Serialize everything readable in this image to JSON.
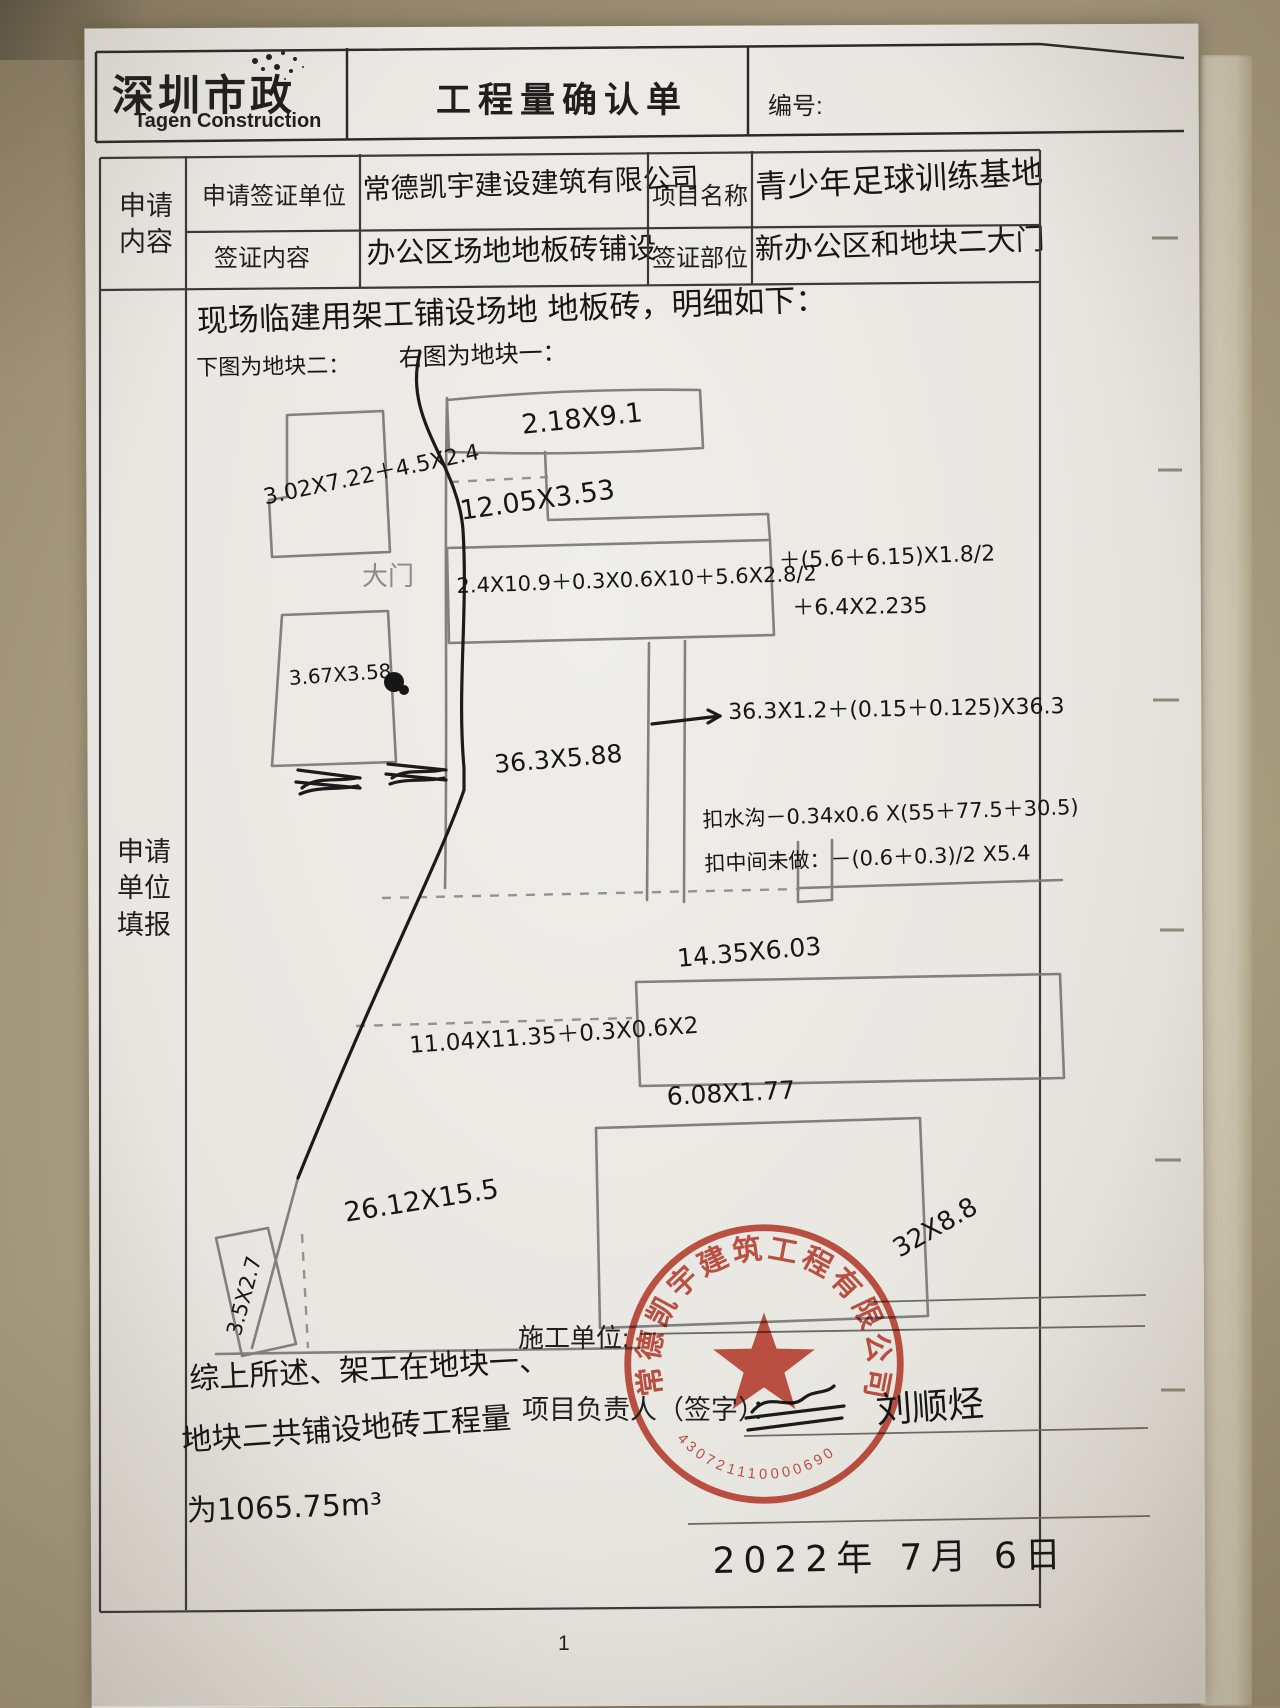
{
  "header": {
    "logo_cn": "深圳市政",
    "logo_en": "Tagen Construction",
    "title": "工程量确认单",
    "no_label": "编号:",
    "no_value": ""
  },
  "form": {
    "row_label_1": "申请",
    "row_label_2": "内容",
    "section_label_1": "申请",
    "section_label_2": "单位",
    "section_label_3": "填报",
    "fields": [
      {
        "label": "申请签证单位",
        "value": "常德凯宇建设建筑有限公司"
      },
      {
        "label": "项目名称",
        "value": "青少年足球训练基地"
      },
      {
        "label": "签证内容",
        "value": "办公区场地地板砖铺设"
      },
      {
        "label": "签证部位",
        "value": "新办公区和地块二大门"
      }
    ]
  },
  "sketch": {
    "labels": [
      {
        "n": "intro-line-1",
        "t": "现场临建用架工铺设场地 地板砖，明细如下：",
        "x": 196,
        "y": 296,
        "s": 31,
        "r": -2
      },
      {
        "n": "intro-line-2-left",
        "t": "下图为地块二：",
        "x": 196,
        "y": 350,
        "s": 22,
        "r": -1
      },
      {
        "n": "intro-line-2-right",
        "t": "右图为地块一：",
        "x": 398,
        "y": 338,
        "s": 24,
        "r": -2
      },
      {
        "n": "dim-plot1-top",
        "t": "2.18X9.1",
        "x": 520,
        "y": 410,
        "s": 27,
        "r": -6
      },
      {
        "n": "dim-plot1-second",
        "t": "12.05X3.53",
        "x": 458,
        "y": 496,
        "s": 27,
        "r": -8
      },
      {
        "n": "dim-plot2-rect1",
        "t": "3.02X7.22＋4.5X2.4",
        "x": 260,
        "y": 480,
        "s": 22,
        "r": -12
      },
      {
        "n": "gate-label",
        "t": "大门",
        "x": 362,
        "y": 556,
        "s": 26,
        "r": 0,
        "c": "#8a8a8a"
      },
      {
        "n": "dim-bar-formula",
        "t": "2.4X10.9＋0.3X0.6X10＋5.6X2.8/2",
        "x": 456,
        "y": 570,
        "s": 21,
        "r": -2
      },
      {
        "n": "dim-bar-formula-2",
        "t": "＋(5.6＋6.15)X1.8/2",
        "x": 778,
        "y": 543,
        "s": 22,
        "r": -2
      },
      {
        "n": "dim-bar-formula-3",
        "t": "＋6.4X2.235",
        "x": 792,
        "y": 590,
        "s": 22,
        "r": -1
      },
      {
        "n": "dim-plot2-rect2",
        "t": "3.67X3.58",
        "x": 288,
        "y": 666,
        "s": 20,
        "r": -4
      },
      {
        "n": "dim-strip",
        "t": "36.3X5.88",
        "x": 493,
        "y": 750,
        "s": 25,
        "r": -5
      },
      {
        "n": "dim-strip-formula",
        "t": "36.3X1.2＋(0.15＋0.125)X36.3",
        "x": 728,
        "y": 694,
        "s": 22,
        "r": -1
      },
      {
        "n": "deduct-ditch",
        "t": "扣水沟－0.34x0.6 X(55＋77.5＋30.5)",
        "x": 702,
        "y": 804,
        "s": 21,
        "r": -2
      },
      {
        "n": "deduct-middle",
        "t": "扣中间未做：－(0.6＋0.3)/2 X5.4",
        "x": 704,
        "y": 848,
        "s": 21,
        "r": -2
      },
      {
        "n": "dim-14-35",
        "t": "14.35X6.03",
        "x": 676,
        "y": 944,
        "s": 25,
        "r": -5
      },
      {
        "n": "dim-11-04",
        "t": "11.04X11.35＋0.3X0.6X2",
        "x": 408,
        "y": 1026,
        "s": 23,
        "r": -4
      },
      {
        "n": "dim-6-08",
        "t": "6.08X1.77",
        "x": 666,
        "y": 1082,
        "s": 25,
        "r": -3
      },
      {
        "n": "dim-26-12",
        "t": "26.12X15.5",
        "x": 342,
        "y": 1198,
        "s": 27,
        "r": -9
      },
      {
        "n": "dim-3-5",
        "t": "3.5X2.7",
        "x": 222,
        "y": 1332,
        "s": 21,
        "r": -75
      },
      {
        "n": "dim-stamp-note",
        "t": "32X8.8",
        "x": 888,
        "y": 1238,
        "s": 26,
        "r": -30
      },
      {
        "n": "summary-line-1",
        "t": "综上所述、架工在地块一、",
        "x": 188,
        "y": 1354,
        "s": 30,
        "r": -3
      },
      {
        "n": "summary-line-2",
        "t": "地块二共铺设地砖工程量",
        "x": 180,
        "y": 1416,
        "s": 30,
        "r": -4
      },
      {
        "n": "summary-line-3",
        "t": "为1065.75m³",
        "x": 186,
        "y": 1486,
        "s": 30,
        "r": -2
      },
      {
        "n": "manager-signature",
        "t": "刘顺烃",
        "x": 874,
        "y": 1382,
        "s": 36,
        "r": -4
      },
      {
        "n": "date-handwritten",
        "t": "2022年 7月 6日",
        "x": 712,
        "y": 1532,
        "s": 36,
        "r": -1,
        "ls": 8
      }
    ]
  },
  "footer": {
    "builder_label": "施工单位:",
    "manager_label": "项目负责人（签字）：",
    "page_number": "1"
  },
  "stamp": {
    "company": "常德凯宇建筑工程有限公司",
    "number": "430721110000690",
    "color": "#c23b2a"
  }
}
